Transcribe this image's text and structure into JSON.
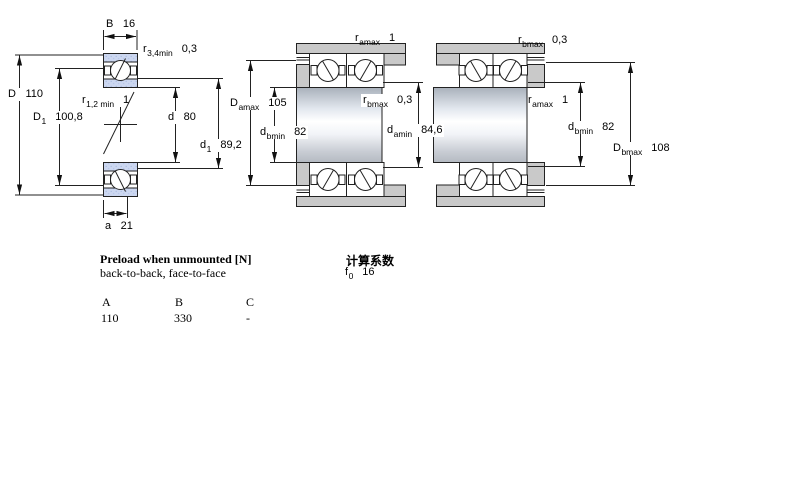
{
  "drawing": {
    "left": {
      "b": {
        "sym": "B",
        "sub": "",
        "val": "16"
      },
      "r34": {
        "sym": "r",
        "sub": "3,4min",
        "val": "0,3"
      },
      "D": {
        "sym": "D",
        "sub": "",
        "val": "110"
      },
      "D1": {
        "sym": "D",
        "sub": "1",
        "val": "100,8"
      },
      "r12": {
        "sym": "r",
        "sub": "1,2 min",
        "val": "1"
      },
      "d": {
        "sym": "d",
        "sub": "",
        "val": "80"
      },
      "d1": {
        "sym": "d",
        "sub": "1",
        "val": "89,2"
      },
      "a": {
        "sym": "a",
        "sub": "",
        "val": "21"
      }
    },
    "middle": {
      "ramax": {
        "sym": "r",
        "sub": "amax",
        "val": "1"
      },
      "Damax": {
        "sym": "D",
        "sub": "amax",
        "val": "105"
      },
      "rbmax": {
        "sym": "r",
        "sub": "bmax",
        "val": "0,3"
      },
      "dbmin": {
        "sym": "d",
        "sub": "bmin",
        "val": "82"
      },
      "damin": {
        "sym": "d",
        "sub": "amin",
        "val": "84,6"
      }
    },
    "right": {
      "rbmax": {
        "sym": "r",
        "sub": "bmax",
        "val": "0,3"
      },
      "ramax": {
        "sym": "r",
        "sub": "amax",
        "val": "1"
      },
      "dbmin": {
        "sym": "d",
        "sub": "bmin",
        "val": "82"
      },
      "Dbmax": {
        "sym": "D",
        "sub": "bmax",
        "val": "108"
      }
    }
  },
  "preload": {
    "title": "Preload when unmounted [N]",
    "subtitle": "back-to-back, face-to-face",
    "columns": [
      "A",
      "B",
      "C"
    ],
    "values": [
      "110",
      "330",
      "-"
    ]
  },
  "factors": {
    "title": "计算系数",
    "f0": {
      "sym": "f",
      "sub": "0",
      "val": "16"
    }
  },
  "colors": {
    "ring_blue": "#ccd7f0",
    "housing_gray": "#c9c9c9",
    "line": "#222222"
  }
}
